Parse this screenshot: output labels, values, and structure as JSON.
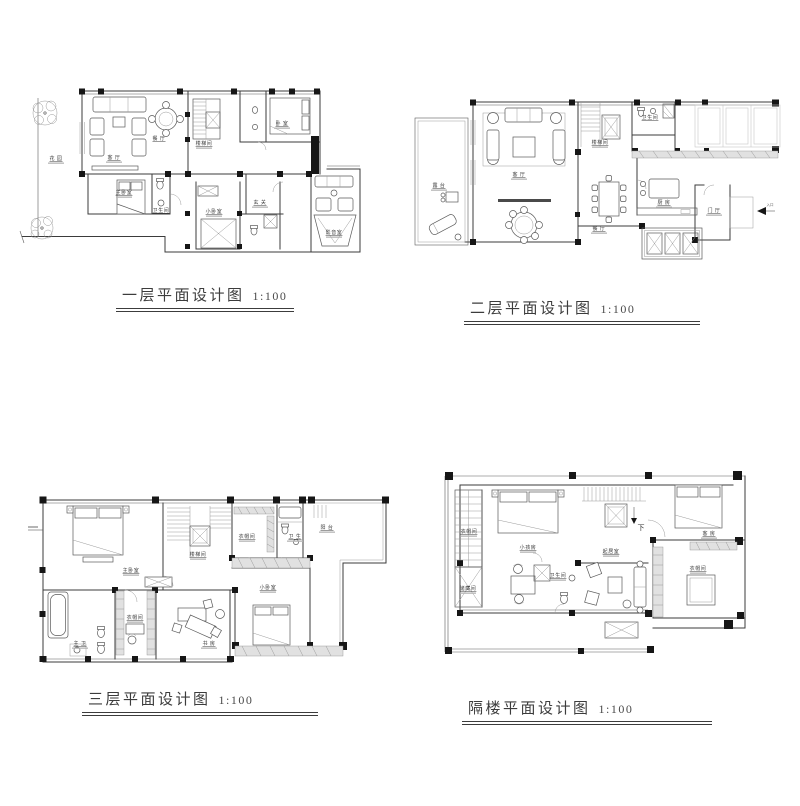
{
  "page": {
    "background": "#ffffff",
    "ink": "#3b3b3b",
    "title_color": "#3c3c3c"
  },
  "plans": [
    {
      "id": "floor-1",
      "title": "一层平面设计图",
      "scale_label": "1:100",
      "rooms": [
        {
          "label": "花 园"
        },
        {
          "label": "客 厅"
        },
        {
          "label": "餐 厅"
        },
        {
          "label": "楼梯间"
        },
        {
          "label": "卧 室"
        },
        {
          "label": "主卧室"
        },
        {
          "label": "卫生间"
        },
        {
          "label": "小卧室"
        },
        {
          "label": "玄 关"
        },
        {
          "label": "影音室"
        }
      ]
    },
    {
      "id": "floor-2",
      "title": "二层平面设计图",
      "scale_label": "1:100",
      "rooms": [
        {
          "label": "露 台"
        },
        {
          "label": "客 厅"
        },
        {
          "label": "楼梯间"
        },
        {
          "label": "卫生间"
        },
        {
          "label": "餐 厅"
        },
        {
          "label": "厨 房"
        },
        {
          "label": "门 厅"
        },
        {
          "label": "入口"
        }
      ]
    },
    {
      "id": "floor-3",
      "title": "三层平面设计图",
      "scale_label": "1:100",
      "rooms": [
        {
          "label": "主卧室"
        },
        {
          "label": "楼梯间"
        },
        {
          "label": "衣帽间"
        },
        {
          "label": "卫 生"
        },
        {
          "label": "阳 台"
        },
        {
          "label": "主 卫"
        },
        {
          "label": "衣帽间"
        },
        {
          "label": "书 房"
        },
        {
          "label": "小卧室"
        }
      ]
    },
    {
      "id": "floor-4",
      "title": "隔楼平面设计图",
      "scale_label": "1:100",
      "rooms": [
        {
          "label": "衣帽间"
        },
        {
          "label": "储藏间"
        },
        {
          "label": "小孩房"
        },
        {
          "label": "卫生间"
        },
        {
          "label": "起居室"
        },
        {
          "label": "客 房"
        },
        {
          "label": "衣帽间"
        },
        {
          "label": "下"
        }
      ]
    }
  ]
}
